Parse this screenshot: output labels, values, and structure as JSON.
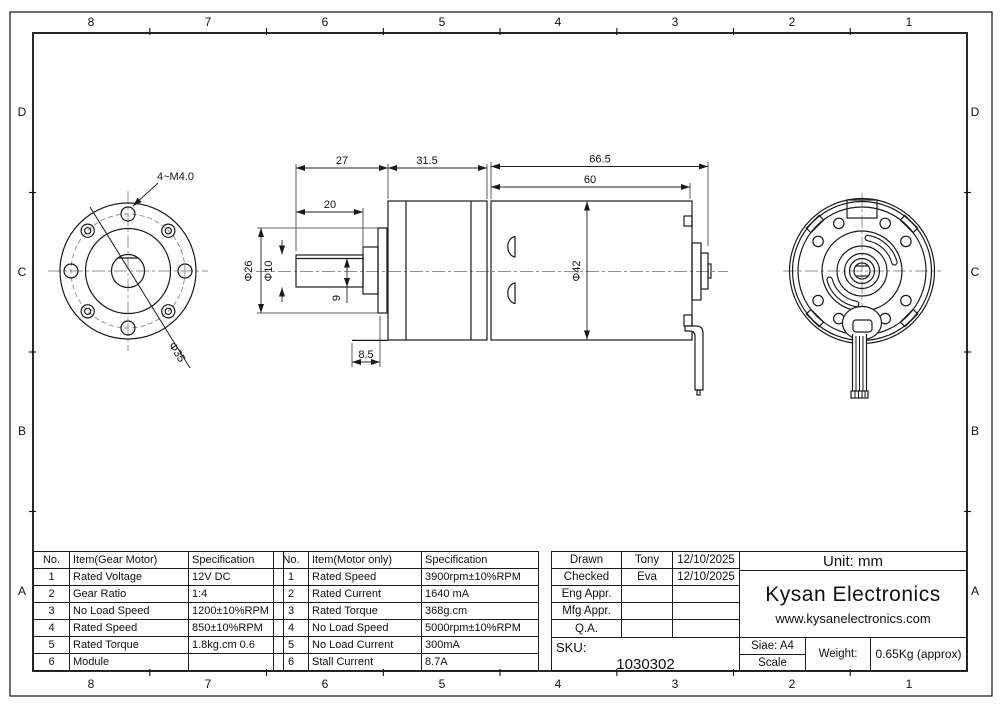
{
  "frame": {
    "cols": [
      "8",
      "7",
      "6",
      "5",
      "4",
      "3",
      "2",
      "1"
    ],
    "rows": [
      "D",
      "C",
      "B",
      "A"
    ]
  },
  "dims": {
    "flat_length": "20",
    "front_length": "27",
    "gearbox_length": "31.5",
    "motor_total_length": "66.5",
    "motor_body_length": "60",
    "boss_diameter": "Φ26",
    "shaft_diameter": "Φ10",
    "flat_height": "9",
    "boss_depth": "8.5",
    "motor_diameter": "Φ42",
    "bolt_circle_diameter": "Φ35",
    "mounting_holes": "4~M4.0"
  },
  "gear_table": {
    "headers": [
      "No.",
      "Item(Gear Motor)",
      "Specification"
    ],
    "rows": [
      [
        "1",
        "Rated Voltage",
        "12V DC"
      ],
      [
        "2",
        "Gear Ratio",
        "1:4"
      ],
      [
        "3",
        "No Load Speed",
        "1200±10%RPM"
      ],
      [
        "4",
        "Rated Speed",
        "850±10%RPM"
      ],
      [
        "5",
        "Rated Torque",
        "1.8kg.cm 0.6"
      ],
      [
        "6",
        "Module",
        ""
      ]
    ]
  },
  "motor_table": {
    "headers": [
      "No.",
      "Item(Motor only)",
      "Specification"
    ],
    "rows": [
      [
        "1",
        "Rated Speed",
        "3900rpm±10%RPM"
      ],
      [
        "2",
        "Rated Current",
        "1640 mA"
      ],
      [
        "3",
        "Rated Torque",
        "368g.cm"
      ],
      [
        "4",
        "No Load Speed",
        "5000rpm±10%RPM"
      ],
      [
        "5",
        "No Load Current",
        "300mA"
      ],
      [
        "6",
        "Stall Current",
        "8.7A"
      ]
    ]
  },
  "title_block": {
    "rows": [
      {
        "label": "Drawn",
        "name": "Tony",
        "date": "12/10/2025"
      },
      {
        "label": "Checked",
        "name": "Eva",
        "date": "12/10/2025"
      },
      {
        "label": "Eng Appr.",
        "name": "",
        "date": ""
      },
      {
        "label": "Mfg Appr.",
        "name": "",
        "date": ""
      },
      {
        "label": "Q.A.",
        "name": "",
        "date": ""
      }
    ],
    "unit": "Unit: mm",
    "company": "Kysan Electronics",
    "website": "www.kysanelectronics.com",
    "sku_label": "SKU:",
    "sku": "1030302",
    "size": "Siae: A4",
    "scale_label": "Scale",
    "weight_label": "Weight:",
    "weight": "0.65Kg (approx)"
  },
  "colors": {
    "line": "#1a1a1a",
    "centerline": "#909090",
    "paper": "#ffffff"
  }
}
